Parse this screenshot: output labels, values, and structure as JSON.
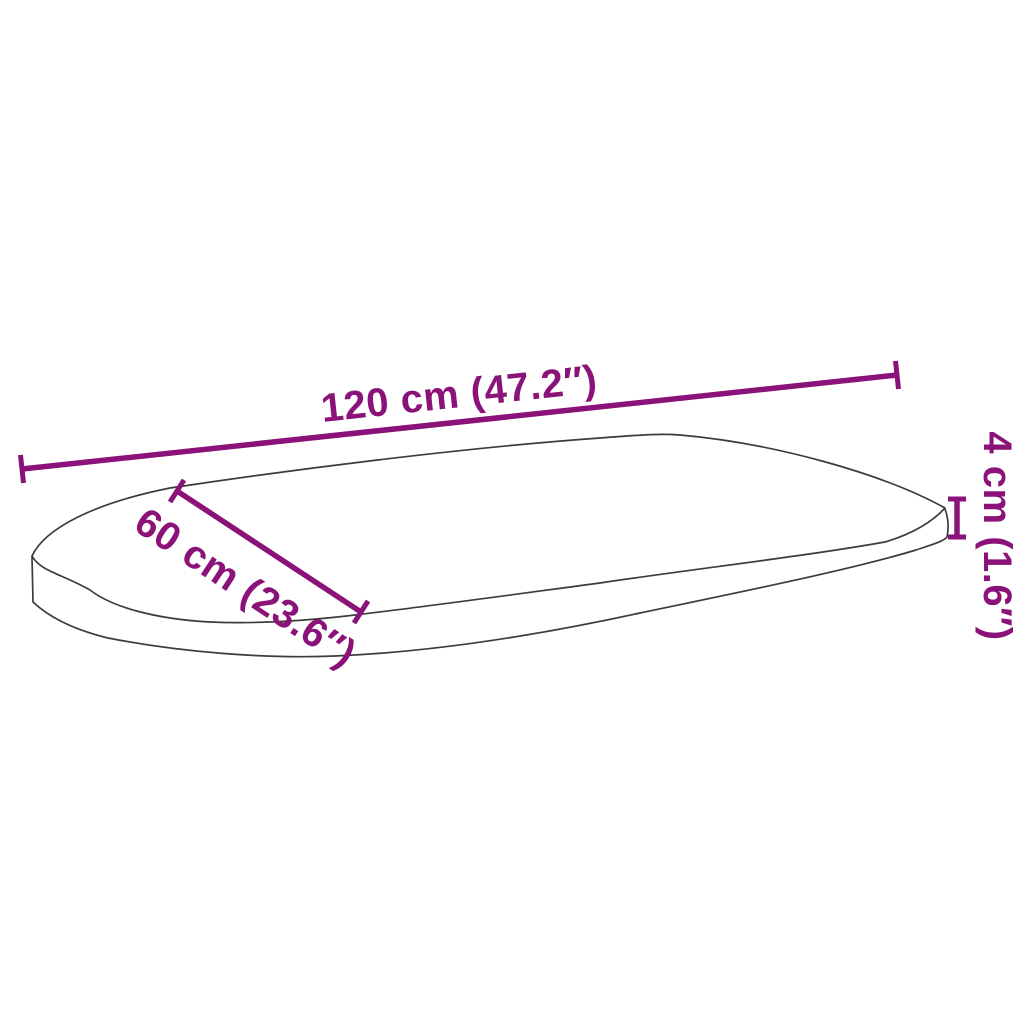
{
  "figure": {
    "type": "product-dimension-diagram",
    "subject": "oval-table-top",
    "background_color": "#ffffff",
    "outline_color": "#3c3c3c",
    "accent_color": "#8a1278"
  },
  "dimensions": {
    "length": {
      "label": "120 cm (47.2″)",
      "cm": "120",
      "inches": "47.2"
    },
    "width": {
      "label": "60 cm (23.6″)",
      "cm": "60",
      "inches": "23.6"
    },
    "thickness": {
      "label": "4 cm (1.6″)",
      "cm": "4",
      "inches": "1.6"
    }
  }
}
